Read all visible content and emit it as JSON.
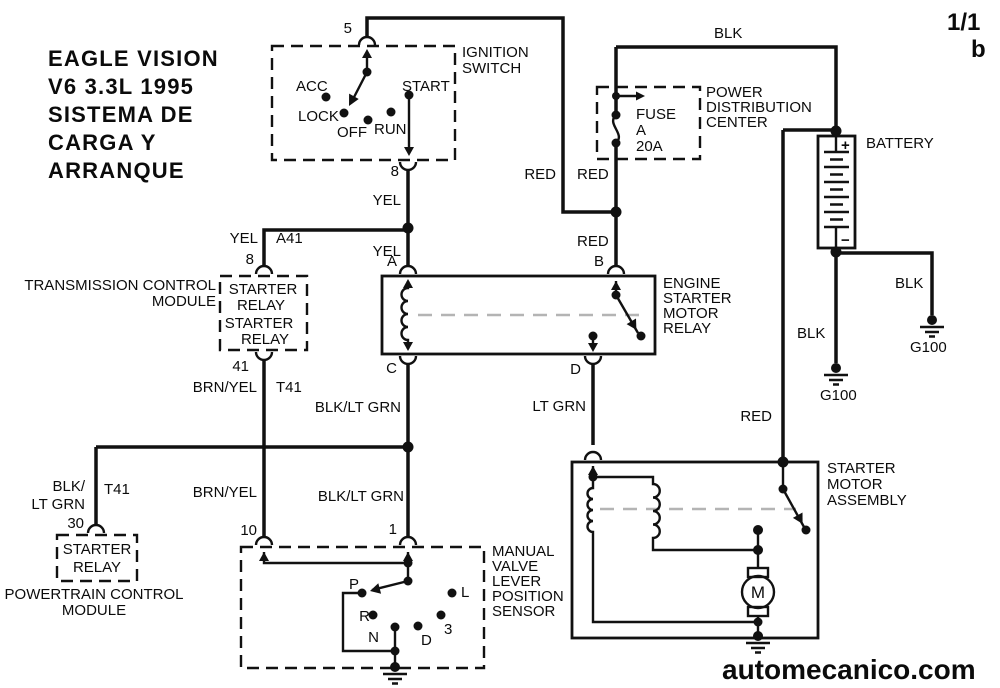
{
  "page": {
    "sheet": "1/1",
    "sheet_sub": "b",
    "watermark": "automecanico.com"
  },
  "colors": {
    "line": "#111111",
    "background": "#ffffff",
    "inner_dash": "#b4b4b4"
  },
  "title": {
    "lines": [
      "EAGLE VISION",
      "V6 3.3L 1995",
      "SISTEMA DE",
      "CARGA Y",
      "ARRANQUE"
    ]
  },
  "ignition_switch": {
    "name": [
      "IGNITION",
      "SWITCH"
    ],
    "pin_top": "5",
    "pin_bottom": "8",
    "pos_acc": "ACC",
    "pos_lock": "LOCK",
    "pos_off": "OFF",
    "pos_run": "RUN",
    "pos_start": "START"
  },
  "power_distribution_center": {
    "name": [
      "POWER",
      "DISTRIBUTION",
      "CENTER"
    ],
    "fuse": [
      "FUSE",
      "A",
      "20A"
    ]
  },
  "battery": {
    "name": "BATTERY",
    "positive": "+",
    "negative": "−",
    "ground_left": "G100",
    "ground_right": "G100"
  },
  "engine_starter_motor_relay": {
    "name": [
      "ENGINE",
      "STARTER",
      "MOTOR",
      "RELAY"
    ],
    "pin_a": "A",
    "pin_b": "B",
    "pin_c": "C",
    "pin_d": "D"
  },
  "transmission_control_module": {
    "name": [
      "TRANSMISSION CONTROL",
      "MODULE"
    ],
    "relay": [
      "STARTER",
      "RELAY",
      "STARTER",
      "RELAY"
    ],
    "pin_top": "8",
    "pin_bottom": "41"
  },
  "powertrain_control_module": {
    "name": [
      "POWERTRAIN CONTROL",
      "MODULE"
    ],
    "relay": [
      "STARTER",
      "RELAY"
    ],
    "pin": "30"
  },
  "manual_valve_lever_position_sensor": {
    "name": [
      "MANUAL",
      "VALVE",
      "LEVER",
      "POSITION",
      "SENSOR"
    ],
    "pin_left": "10",
    "pin_right": "1",
    "pos_p": "P",
    "pos_r": "R",
    "pos_n": "N",
    "pos_d": "D",
    "pos_3": "3",
    "pos_l": "L"
  },
  "starter_motor_assembly": {
    "name": [
      "STARTER",
      "MOTOR",
      "ASSEMBLY"
    ],
    "motor": "M"
  },
  "wire_labels": {
    "blk_top": "BLK",
    "red_ignition": "RED",
    "red_fuse": "RED",
    "red_to_b": "RED",
    "red_battery": "RED",
    "yel_ignition": "YEL",
    "yel_to_a": "YEL",
    "yel_branch": "YEL",
    "circuit_a41": "A41",
    "circuit_t41_tcm": "T41",
    "circuit_t41_pcm": "T41",
    "brnyel_upper": "BRN/YEL",
    "brnyel_lower": "BRN/YEL",
    "blkltgrn_upper": "BLK/LT GRN",
    "blkltgrn_lower": "BLK/LT GRN",
    "blkltgrn_pcm": [
      "BLK/",
      "LT GRN"
    ],
    "ltgrn": "LT GRN",
    "blk_ground_left": "BLK",
    "blk_ground_right": "BLK"
  }
}
